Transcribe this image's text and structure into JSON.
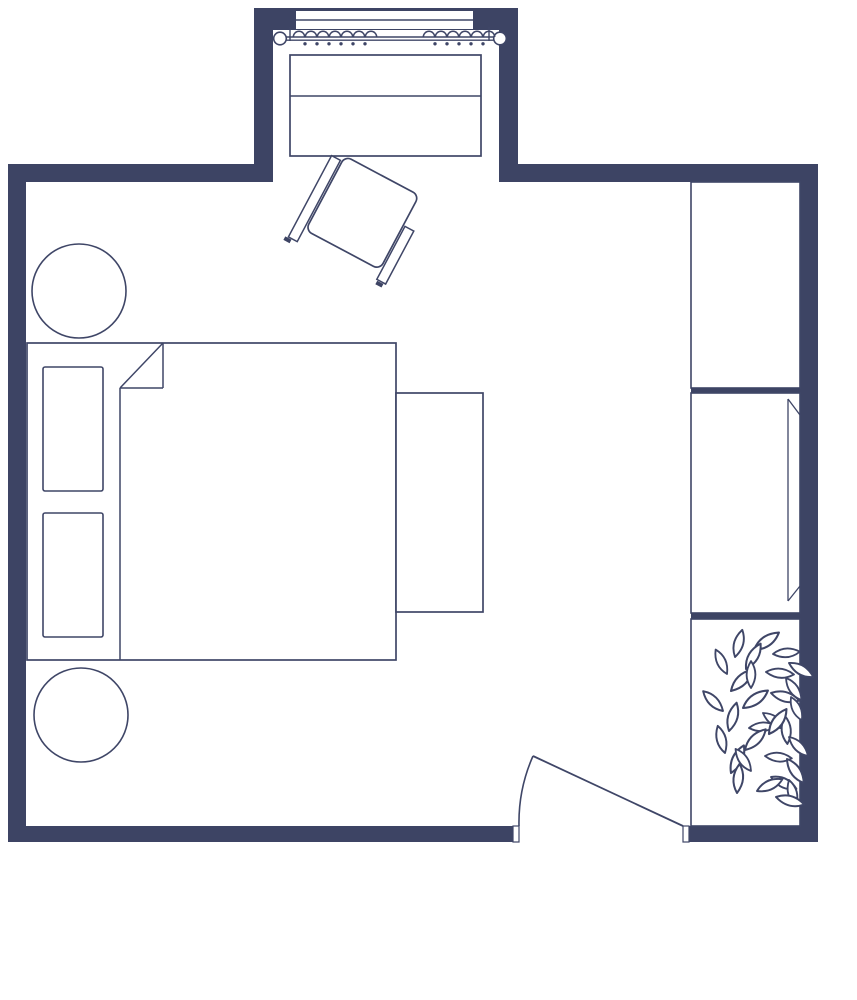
{
  "meta": {
    "type": "floor-plan",
    "room": "bedroom"
  },
  "canvas": {
    "w": 857,
    "h": 1000
  },
  "colors": {
    "wall": "#3d4464",
    "stroke": "#3f4667",
    "white": "#ffffff",
    "bg": "#ffffff"
  },
  "leaf_path": "M0 0 Q8 -11 22 -8 Q14 3 0 0 Z",
  "groups": [
    {
      "name": "walls",
      "interactable": false,
      "items": [
        {
          "type": "rect",
          "n": "wall-alcove-top",
          "x": 254,
          "y": 8,
          "w": 264,
          "h": 22,
          "f": "wall",
          "sw": 0
        },
        {
          "type": "rect",
          "n": "wall-alcove-left",
          "x": 254,
          "y": 8,
          "w": 19,
          "h": 174,
          "f": "wall",
          "sw": 0
        },
        {
          "type": "rect",
          "n": "wall-alcove-right",
          "x": 499,
          "y": 8,
          "w": 19,
          "h": 174,
          "f": "wall",
          "sw": 0
        },
        {
          "type": "rect",
          "n": "wall-top-left",
          "x": 8,
          "y": 164,
          "w": 265,
          "h": 18,
          "f": "wall",
          "sw": 0
        },
        {
          "type": "rect",
          "n": "wall-top-right",
          "x": 499,
          "y": 164,
          "w": 319,
          "h": 18,
          "f": "wall",
          "sw": 0
        },
        {
          "type": "rect",
          "n": "wall-left",
          "x": 8,
          "y": 164,
          "w": 18,
          "h": 678,
          "f": "wall",
          "sw": 0
        },
        {
          "type": "rect",
          "n": "wall-right",
          "x": 800,
          "y": 164,
          "w": 18,
          "h": 678,
          "f": "wall",
          "sw": 0
        },
        {
          "type": "rect",
          "n": "wall-bottom-left",
          "x": 8,
          "y": 826,
          "w": 506,
          "h": 16,
          "f": "wall",
          "sw": 0
        },
        {
          "type": "rect",
          "n": "wall-bottom-right",
          "x": 689,
          "y": 826,
          "w": 129,
          "h": 16,
          "f": "wall",
          "sw": 0
        }
      ]
    },
    {
      "name": "window",
      "interactable": false,
      "items": [
        {
          "type": "rect",
          "n": "window-pane",
          "x": 296,
          "y": 11,
          "w": 177,
          "h": 18,
          "f": "white",
          "sw": 0
        },
        {
          "type": "line",
          "n": "window-mullion",
          "x1": 296,
          "y1": 20,
          "x2": 473,
          "y2": 20,
          "sw": 1.6
        }
      ]
    },
    {
      "name": "curtain",
      "interactable": false,
      "items": [
        {
          "type": "line",
          "n": "curtain-rod",
          "x1": 286,
          "y1": 37,
          "x2": 494,
          "y2": 37,
          "sw": 1.4
        },
        {
          "type": "line",
          "n": "curtain-rod",
          "x1": 286,
          "y1": 40.2,
          "x2": 494,
          "y2": 40.2,
          "sw": 1.4
        },
        {
          "type": "line",
          "n": "curtain-bracket",
          "x1": 290,
          "y1": 27,
          "x2": 290,
          "y2": 41,
          "sw": 1.4
        },
        {
          "type": "line",
          "n": "curtain-bracket",
          "x1": 489,
          "y1": 27,
          "x2": 489,
          "y2": 41,
          "sw": 1.4
        },
        {
          "type": "circle",
          "n": "curtain-finial",
          "cx": 280,
          "cy": 38.5,
          "r": 6.3,
          "f": "white",
          "sw": 1.6
        },
        {
          "type": "circle",
          "n": "curtain-finial",
          "cx": 500,
          "cy": 38.5,
          "r": 6.3,
          "f": "white",
          "sw": 1.6
        },
        {
          "type": "scallop",
          "n": "curtain-ring",
          "cx": 299,
          "y": 37,
          "r": 5.7
        },
        {
          "type": "scallop",
          "n": "curtain-ring",
          "cx": 311,
          "y": 37,
          "r": 5.7
        },
        {
          "type": "scallop",
          "n": "curtain-ring",
          "cx": 323,
          "y": 37,
          "r": 5.7
        },
        {
          "type": "scallop",
          "n": "curtain-ring",
          "cx": 335,
          "y": 37,
          "r": 5.7
        },
        {
          "type": "scallop",
          "n": "curtain-ring",
          "cx": 347,
          "y": 37,
          "r": 5.7
        },
        {
          "type": "scallop",
          "n": "curtain-ring",
          "cx": 359,
          "y": 37,
          "r": 5.7
        },
        {
          "type": "scallop",
          "n": "curtain-ring",
          "cx": 371,
          "y": 37,
          "r": 5.7
        },
        {
          "type": "scallop",
          "n": "curtain-ring",
          "cx": 429,
          "y": 37,
          "r": 5.7
        },
        {
          "type": "scallop",
          "n": "curtain-ring",
          "cx": 441,
          "y": 37,
          "r": 5.7
        },
        {
          "type": "scallop",
          "n": "curtain-ring",
          "cx": 453,
          "y": 37,
          "r": 5.7
        },
        {
          "type": "scallop",
          "n": "curtain-ring",
          "cx": 465,
          "y": 37,
          "r": 5.7
        },
        {
          "type": "scallop",
          "n": "curtain-ring",
          "cx": 477,
          "y": 37,
          "r": 5.7
        },
        {
          "type": "scallop",
          "n": "curtain-ring",
          "cx": 489,
          "y": 37,
          "r": 5.7
        },
        {
          "type": "dot",
          "n": "curtain-hook",
          "cx": 305,
          "cy": 43.8,
          "r": 1.7
        },
        {
          "type": "dot",
          "n": "curtain-hook",
          "cx": 317,
          "cy": 43.8,
          "r": 1.7
        },
        {
          "type": "dot",
          "n": "curtain-hook",
          "cx": 329,
          "cy": 43.8,
          "r": 1.7
        },
        {
          "type": "dot",
          "n": "curtain-hook",
          "cx": 341,
          "cy": 43.8,
          "r": 1.7
        },
        {
          "type": "dot",
          "n": "curtain-hook",
          "cx": 353,
          "cy": 43.8,
          "r": 1.7
        },
        {
          "type": "dot",
          "n": "curtain-hook",
          "cx": 365,
          "cy": 43.8,
          "r": 1.7
        },
        {
          "type": "dot",
          "n": "curtain-hook",
          "cx": 435,
          "cy": 43.8,
          "r": 1.7
        },
        {
          "type": "dot",
          "n": "curtain-hook",
          "cx": 447,
          "cy": 43.8,
          "r": 1.7
        },
        {
          "type": "dot",
          "n": "curtain-hook",
          "cx": 459,
          "cy": 43.8,
          "r": 1.7
        },
        {
          "type": "dot",
          "n": "curtain-hook",
          "cx": 471,
          "cy": 43.8,
          "r": 1.7
        },
        {
          "type": "dot",
          "n": "curtain-hook",
          "cx": 483,
          "cy": 43.8,
          "r": 1.7
        }
      ]
    },
    {
      "name": "dresser",
      "interactable": false,
      "items": [
        {
          "type": "rect",
          "n": "dresser-body",
          "x": 290,
          "y": 55,
          "w": 191,
          "h": 101,
          "f": "white",
          "sw": 1.7
        },
        {
          "type": "line",
          "n": "dresser-divider",
          "x1": 290,
          "y1": 96,
          "x2": 481,
          "y2": 96,
          "sw": 1.5
        }
      ]
    },
    {
      "name": "desk-chair",
      "interactable": false,
      "transform": "translate(345,156) rotate(28)",
      "items": [
        {
          "type": "rect",
          "n": "chair-arm-left",
          "x": -12,
          "y": 6,
          "w": 10,
          "h": 92,
          "f": "white",
          "sw": 1.5
        },
        {
          "type": "rect",
          "n": "chair-arm-right",
          "x": 86,
          "y": 34,
          "w": 10,
          "h": 60,
          "f": "white",
          "sw": 1.5
        },
        {
          "type": "rect",
          "n": "chair-seat",
          "x": 0,
          "y": 0,
          "w": 84,
          "h": 84,
          "rx": 7,
          "f": "white",
          "sw": 1.7
        },
        {
          "type": "rect",
          "n": "chair-foot",
          "x": -15,
          "y": 99,
          "w": 7,
          "h": 4,
          "f": "wall",
          "sw": 0
        },
        {
          "type": "rect",
          "n": "chair-foot",
          "x": 87,
          "y": 95,
          "w": 7,
          "h": 4,
          "f": "wall",
          "sw": 0
        }
      ]
    },
    {
      "name": "side-table-top",
      "interactable": false,
      "items": [
        {
          "type": "circle",
          "n": "side-table-round",
          "cx": 79,
          "cy": 291,
          "r": 47,
          "f": "white",
          "sw": 1.6
        }
      ]
    },
    {
      "name": "side-table-bottom",
      "interactable": false,
      "items": [
        {
          "type": "circle",
          "n": "side-table-round",
          "cx": 81,
          "cy": 715,
          "r": 47,
          "f": "white",
          "sw": 1.6
        }
      ]
    },
    {
      "name": "bed",
      "interactable": false,
      "items": [
        {
          "type": "rect",
          "n": "bed-frame",
          "x": 27,
          "y": 343,
          "w": 369,
          "h": 317,
          "f": "white",
          "sw": 1.7
        },
        {
          "type": "rect",
          "n": "bed-pillow",
          "x": 43,
          "y": 367,
          "w": 60,
          "h": 124,
          "rx": 2,
          "f": "white",
          "sw": 1.6
        },
        {
          "type": "rect",
          "n": "bed-pillow",
          "x": 43,
          "y": 513,
          "w": 60,
          "h": 124,
          "rx": 2,
          "f": "white",
          "sw": 1.6
        },
        {
          "type": "line",
          "n": "blanket-fold",
          "x1": 163,
          "y1": 343,
          "x2": 163,
          "y2": 388,
          "sw": 1.5
        },
        {
          "type": "line",
          "n": "blanket-fold",
          "x1": 120,
          "y1": 388,
          "x2": 163,
          "y2": 388,
          "sw": 1.5
        },
        {
          "type": "line",
          "n": "blanket-fold",
          "x1": 163,
          "y1": 343,
          "x2": 120,
          "y2": 388,
          "sw": 1.5
        },
        {
          "type": "line",
          "n": "blanket-edge",
          "x1": 120,
          "y1": 388,
          "x2": 120,
          "y2": 660,
          "sw": 1.5
        }
      ]
    },
    {
      "name": "bench",
      "interactable": false,
      "items": [
        {
          "type": "rect",
          "n": "bench-body",
          "x": 396,
          "y": 393,
          "w": 87,
          "h": 219,
          "f": "white",
          "sw": 1.7
        }
      ]
    },
    {
      "name": "closet",
      "interactable": false,
      "items": [
        {
          "type": "rect",
          "n": "closet-cabinet-top",
          "x": 691,
          "y": 182,
          "w": 109,
          "h": 206,
          "f": "white",
          "sw": 1.6
        },
        {
          "type": "rect",
          "n": "closet-divider",
          "x": 691,
          "y": 388,
          "w": 109,
          "h": 5,
          "f": "wall",
          "sw": 0
        },
        {
          "type": "rect",
          "n": "closet-cabinet-middle",
          "x": 691,
          "y": 393,
          "w": 109,
          "h": 220,
          "f": "white",
          "sw": 1.6
        },
        {
          "type": "rect",
          "n": "closet-divider",
          "x": 691,
          "y": 613,
          "w": 109,
          "h": 6,
          "f": "wall",
          "sw": 0
        },
        {
          "type": "rect",
          "n": "closet-cabinet-bottom",
          "x": 691,
          "y": 619,
          "w": 109,
          "h": 207,
          "f": "white",
          "sw": 1.6
        },
        {
          "type": "line",
          "n": "mirror-edge",
          "x1": 788,
          "y1": 399,
          "x2": 800,
          "y2": 415,
          "sw": 1.3
        },
        {
          "type": "line",
          "n": "mirror-face",
          "x1": 788,
          "y1": 399,
          "x2": 788,
          "y2": 601,
          "sw": 1.3
        },
        {
          "type": "line",
          "n": "mirror-edge",
          "x1": 788,
          "y1": 601,
          "x2": 800,
          "y2": 586,
          "sw": 1.3
        }
      ]
    },
    {
      "name": "plant",
      "interactable": false,
      "items": [
        {
          "type": "leaf",
          "x": 735,
          "y": 657,
          "r": -55,
          "s": 1.2
        },
        {
          "type": "leaf",
          "x": 754,
          "y": 650,
          "r": -15,
          "s": 1.3
        },
        {
          "type": "leaf",
          "x": 773,
          "y": 654,
          "r": 15,
          "s": 1.15
        },
        {
          "type": "leaf",
          "x": 789,
          "y": 663,
          "r": 50,
          "s": 1.2
        },
        {
          "type": "leaf",
          "x": 727,
          "y": 674,
          "r": -95,
          "s": 1.15
        },
        {
          "type": "leaf",
          "x": 746,
          "y": 669,
          "r": -40,
          "s": 1.25
        },
        {
          "type": "leaf",
          "x": 766,
          "y": 672,
          "r": 25,
          "s": 1.2
        },
        {
          "type": "leaf",
          "x": 786,
          "y": 678,
          "r": 75,
          "s": 1.15
        },
        {
          "type": "leaf",
          "x": 731,
          "y": 691,
          "r": -25,
          "s": 1.3
        },
        {
          "type": "leaf",
          "x": 751,
          "y": 688,
          "r": -70,
          "s": 1.15
        },
        {
          "type": "leaf",
          "x": 771,
          "y": 693,
          "r": 35,
          "s": 1.25
        },
        {
          "type": "leaf",
          "x": 791,
          "y": 697,
          "r": 85,
          "s": 1.1
        },
        {
          "type": "leaf",
          "x": 723,
          "y": 711,
          "r": -115,
          "s": 1.2
        },
        {
          "type": "leaf",
          "x": 743,
          "y": 708,
          "r": -15,
          "s": 1.3
        },
        {
          "type": "leaf",
          "x": 763,
          "y": 713,
          "r": 55,
          "s": 1.15
        },
        {
          "type": "leaf",
          "x": 785,
          "y": 716,
          "r": 105,
          "s": 1.2
        },
        {
          "type": "leaf",
          "x": 729,
          "y": 731,
          "r": -55,
          "s": 1.25
        },
        {
          "type": "leaf",
          "x": 749,
          "y": 728,
          "r": 15,
          "s": 1.15
        },
        {
          "type": "leaf",
          "x": 769,
          "y": 734,
          "r": -35,
          "s": 1.3
        },
        {
          "type": "leaf",
          "x": 789,
          "y": 737,
          "r": 65,
          "s": 1.15
        },
        {
          "type": "leaf",
          "x": 725,
          "y": 753,
          "r": -85,
          "s": 1.2
        },
        {
          "type": "leaf",
          "x": 745,
          "y": 750,
          "r": -25,
          "s": 1.25
        },
        {
          "type": "leaf",
          "x": 765,
          "y": 756,
          "r": 25,
          "s": 1.15
        },
        {
          "type": "leaf",
          "x": 787,
          "y": 759,
          "r": 75,
          "s": 1.25
        },
        {
          "type": "leaf",
          "x": 731,
          "y": 773,
          "r": -45,
          "s": 1.3
        },
        {
          "type": "leaf",
          "x": 751,
          "y": 771,
          "r": -105,
          "s": 1.15
        },
        {
          "type": "leaf",
          "x": 771,
          "y": 777,
          "r": 45,
          "s": 1.2
        },
        {
          "type": "leaf",
          "x": 789,
          "y": 780,
          "r": 95,
          "s": 1.15
        },
        {
          "type": "leaf",
          "x": 737,
          "y": 793,
          "r": -65,
          "s": 1.25
        },
        {
          "type": "leaf",
          "x": 757,
          "y": 791,
          "r": -5,
          "s": 1.2
        },
        {
          "type": "leaf",
          "x": 776,
          "y": 797,
          "r": 35,
          "s": 1.25
        }
      ]
    },
    {
      "name": "door",
      "interactable": false,
      "items": [
        {
          "type": "rect",
          "n": "door-jamb",
          "x": 513,
          "y": 826,
          "w": 6,
          "h": 16,
          "f": "white",
          "sw": 1.2
        },
        {
          "type": "rect",
          "n": "door-jamb",
          "x": 683,
          "y": 826,
          "w": 6,
          "h": 16,
          "f": "white",
          "sw": 1.2
        },
        {
          "type": "path",
          "n": "door-swing-arc",
          "d": "M519 826 A164 164 0 0 1 533 756",
          "f": "none",
          "sw": 1.6
        },
        {
          "type": "line",
          "n": "door-leaf",
          "x1": 533,
          "y1": 756,
          "x2": 683,
          "y2": 826,
          "sw": 1.8
        }
      ]
    }
  ]
}
